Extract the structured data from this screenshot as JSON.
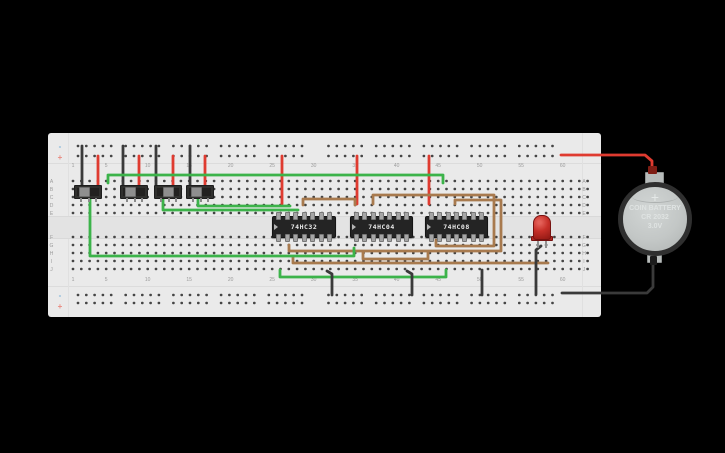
{
  "app": {
    "background": "#000000"
  },
  "palette": {
    "board": "#eaeaea",
    "hole": "#454545",
    "label": "#9b9b9b",
    "rail_minus": "#7ab1d8",
    "rail_plus": "#e98a80",
    "wire_red": "#df3b30",
    "wire_black": "#3a3a3a",
    "wire_green": "#3cb34a",
    "wire_brown": "#a87a4e"
  },
  "breadboard": {
    "rail_minus_label": "-",
    "rail_plus_label": "+",
    "row_labels_top": [
      "A",
      "B",
      "C",
      "D",
      "E"
    ],
    "row_labels_bottom": [
      "F",
      "G",
      "H",
      "I",
      "J"
    ],
    "column_labels": [
      1,
      5,
      10,
      15,
      20,
      25,
      30,
      35,
      40,
      45,
      50,
      55,
      60
    ]
  },
  "components": {
    "switches": [
      {
        "name": "slide-switch-1",
        "x": 74,
        "knob_offset": 4
      },
      {
        "name": "slide-switch-2",
        "x": 120,
        "knob_offset": 4
      },
      {
        "name": "slide-switch-3",
        "x": 154,
        "knob_offset": 8
      },
      {
        "name": "slide-switch-4",
        "x": 186,
        "knob_offset": 4
      }
    ],
    "ics": [
      {
        "name": "ic-74hc32",
        "label": "74HC32",
        "x": 272,
        "w": 62
      },
      {
        "name": "ic-74hc04",
        "label": "74HC04",
        "x": 350,
        "w": 61
      },
      {
        "name": "ic-74hc08",
        "label": "74HC08",
        "x": 425,
        "w": 61
      }
    ],
    "led": {
      "name": "red-led",
      "color": "#c62f28"
    },
    "battery": {
      "name": "coin-battery",
      "plus": "+",
      "line1": "COIN BATTERY",
      "line2": "CR 2032",
      "line3": "3.0V"
    }
  },
  "wires": [
    {
      "name": "wire-black-sw1-gnd",
      "color": "#3a3a3a",
      "points": [
        [
          82,
          146
        ],
        [
          82,
          187
        ]
      ]
    },
    {
      "name": "wire-black-sw2-gnd",
      "color": "#3a3a3a",
      "points": [
        [
          123,
          146
        ],
        [
          123,
          187
        ]
      ]
    },
    {
      "name": "wire-black-sw3-gnd",
      "color": "#3a3a3a",
      "points": [
        [
          156,
          146
        ],
        [
          156,
          187
        ]
      ]
    },
    {
      "name": "wire-black-sw4-gnd",
      "color": "#3a3a3a",
      "points": [
        [
          190,
          146
        ],
        [
          190,
          187
        ]
      ]
    },
    {
      "name": "wire-red-sw1-vcc",
      "color": "#df3b30",
      "points": [
        [
          98,
          156
        ],
        [
          98,
          187
        ]
      ]
    },
    {
      "name": "wire-red-sw2-vcc",
      "color": "#df3b30",
      "points": [
        [
          139,
          156
        ],
        [
          139,
          187
        ]
      ]
    },
    {
      "name": "wire-red-sw3-vcc",
      "color": "#df3b30",
      "points": [
        [
          173,
          156
        ],
        [
          173,
          187
        ]
      ]
    },
    {
      "name": "wire-red-sw4-vcc",
      "color": "#df3b30",
      "points": [
        [
          205,
          156
        ],
        [
          205,
          187
        ]
      ]
    },
    {
      "name": "wire-red-ic1-vcc",
      "color": "#df3b30",
      "points": [
        [
          282,
          156
        ],
        [
          282,
          204
        ]
      ]
    },
    {
      "name": "wire-red-ic2-vcc",
      "color": "#df3b30",
      "points": [
        [
          357,
          156
        ],
        [
          357,
          204
        ]
      ]
    },
    {
      "name": "wire-red-ic3-vcc",
      "color": "#df3b30",
      "points": [
        [
          429,
          156
        ],
        [
          429,
          204
        ]
      ]
    },
    {
      "name": "wire-red-battery-pos",
      "color": "#df3b30",
      "points": [
        [
          561,
          155
        ],
        [
          645,
          155
        ],
        [
          652,
          161
        ],
        [
          652,
          177
        ]
      ]
    },
    {
      "name": "wire-brown-ic1-ic2",
      "color": "#a87a4e",
      "points": [
        [
          303,
          205
        ],
        [
          303,
          199
        ],
        [
          355,
          199
        ],
        [
          355,
          205
        ]
      ]
    },
    {
      "name": "wire-brown-ic2-ic3-top",
      "color": "#a87a4e",
      "points": [
        [
          373,
          204
        ],
        [
          373,
          195
        ],
        [
          494,
          195
        ],
        [
          494,
          246
        ],
        [
          436,
          246
        ],
        [
          436,
          240
        ]
      ]
    },
    {
      "name": "wire-brown-ic3-loop",
      "color": "#a87a4e",
      "points": [
        [
          455,
          204
        ],
        [
          455,
          200
        ],
        [
          501,
          200
        ],
        [
          501,
          251
        ],
        [
          289,
          251
        ],
        [
          289,
          245
        ]
      ]
    },
    {
      "name": "wire-brown-row-i-led",
      "color": "#a87a4e",
      "points": [
        [
          293,
          257
        ],
        [
          293,
          263
        ],
        [
          548,
          263
        ]
      ]
    },
    {
      "name": "wire-brown-ic2-ic3-bottom",
      "color": "#a87a4e",
      "points": [
        [
          363,
          252
        ],
        [
          363,
          259
        ],
        [
          428,
          259
        ],
        [
          428,
          252
        ]
      ]
    },
    {
      "name": "wire-green-top-long",
      "color": "#3cb34a",
      "points": [
        [
          108,
          183
        ],
        [
          108,
          175
        ],
        [
          443,
          175
        ],
        [
          443,
          183
        ]
      ]
    },
    {
      "name": "wire-green-sw3-ic1",
      "color": "#3cb34a",
      "points": [
        [
          163,
          197
        ],
        [
          163,
          210
        ],
        [
          298,
          210
        ]
      ]
    },
    {
      "name": "wire-green-sw4-ic1",
      "color": "#3cb34a",
      "points": [
        [
          198,
          197
        ],
        [
          198,
          206
        ],
        [
          290,
          206
        ]
      ]
    },
    {
      "name": "wire-green-sw1-row-h",
      "color": "#3cb34a",
      "points": [
        [
          90,
          199
        ],
        [
          90,
          256
        ],
        [
          354,
          256
        ],
        [
          354,
          248
        ]
      ]
    },
    {
      "name": "wire-green-row-j",
      "color": "#3cb34a",
      "points": [
        [
          280,
          270
        ],
        [
          280,
          277
        ],
        [
          446,
          277
        ],
        [
          446,
          270
        ]
      ]
    },
    {
      "name": "wire-black-gnd-1",
      "color": "#3a3a3a",
      "points": [
        [
          327,
          271
        ],
        [
          332,
          274
        ],
        [
          332,
          295
        ]
      ]
    },
    {
      "name": "wire-black-gnd-2",
      "color": "#3a3a3a",
      "points": [
        [
          407,
          271
        ],
        [
          412,
          274
        ],
        [
          412,
          295
        ]
      ]
    },
    {
      "name": "wire-black-gnd-3",
      "color": "#3a3a3a",
      "points": [
        [
          482,
          270
        ],
        [
          482,
          295
        ]
      ]
    },
    {
      "name": "wire-black-led-gnd",
      "color": "#3a3a3a",
      "points": [
        [
          541,
          246
        ],
        [
          536,
          250
        ],
        [
          536,
          294
        ]
      ]
    },
    {
      "name": "wire-black-battery-neg",
      "color": "#3a3a3a",
      "points": [
        [
          653,
          260
        ],
        [
          653,
          287
        ],
        [
          647,
          293
        ],
        [
          562,
          293
        ]
      ]
    }
  ]
}
